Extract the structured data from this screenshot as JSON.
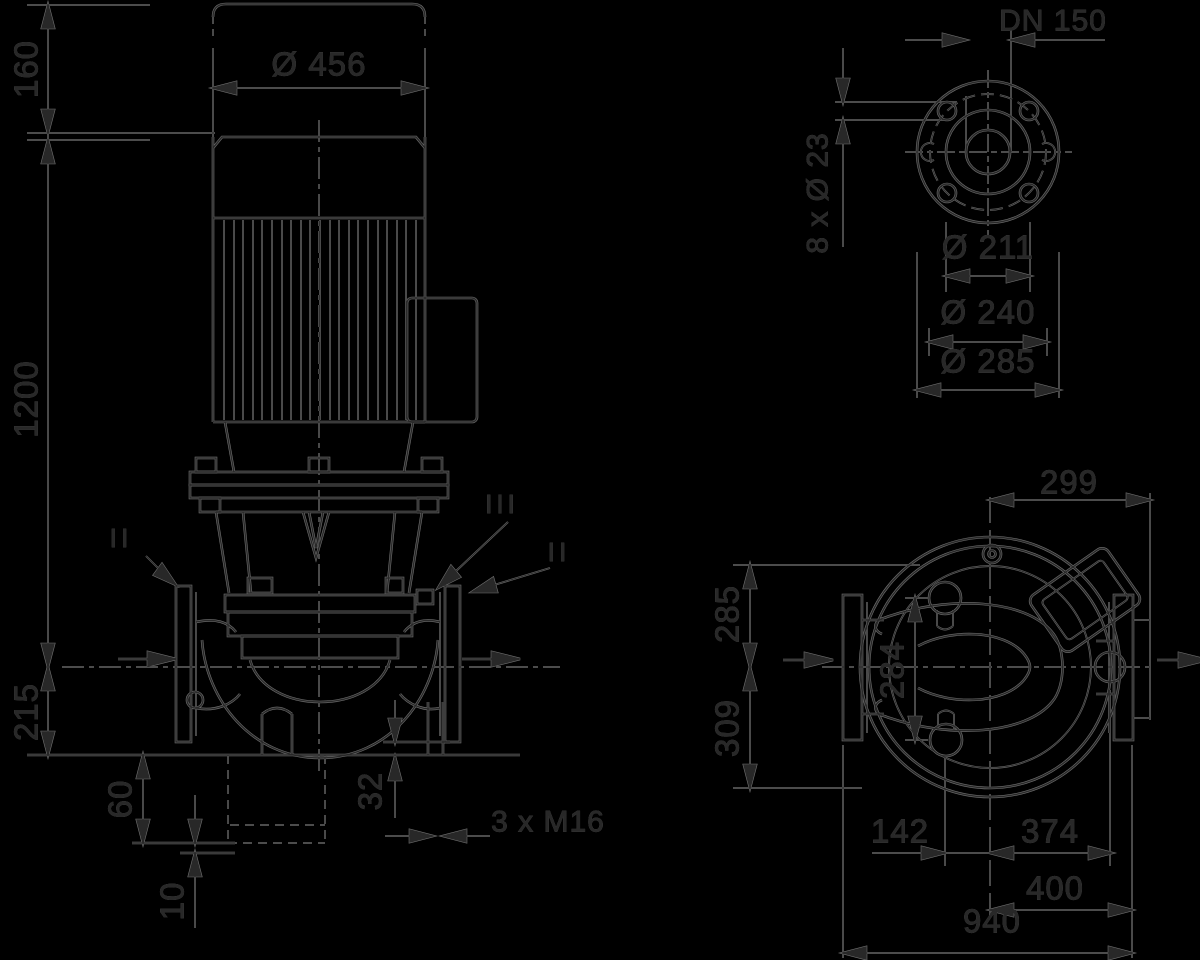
{
  "front": {
    "d456": "Ø 456",
    "d160": "160",
    "d1200": "1200",
    "d215": "215",
    "d60": "60",
    "d10": "10",
    "d32": "32",
    "m16": "3 x M16",
    "sec_left": "II",
    "sec_right": "II",
    "sec_detail": "III"
  },
  "flange": {
    "dn": "DN 150",
    "holes": "8 x Ø 23",
    "d211": "Ø 211",
    "d240": "Ø 240",
    "d285": "Ø 285"
  },
  "plan": {
    "d299": "299",
    "d285": "285",
    "d309": "309",
    "d284": "284",
    "d142": "142",
    "d374": "374",
    "d400": "400",
    "d940": "940"
  },
  "colors": {
    "background": "#000000",
    "ink": "#282828",
    "halo": "#6f6f6f"
  }
}
